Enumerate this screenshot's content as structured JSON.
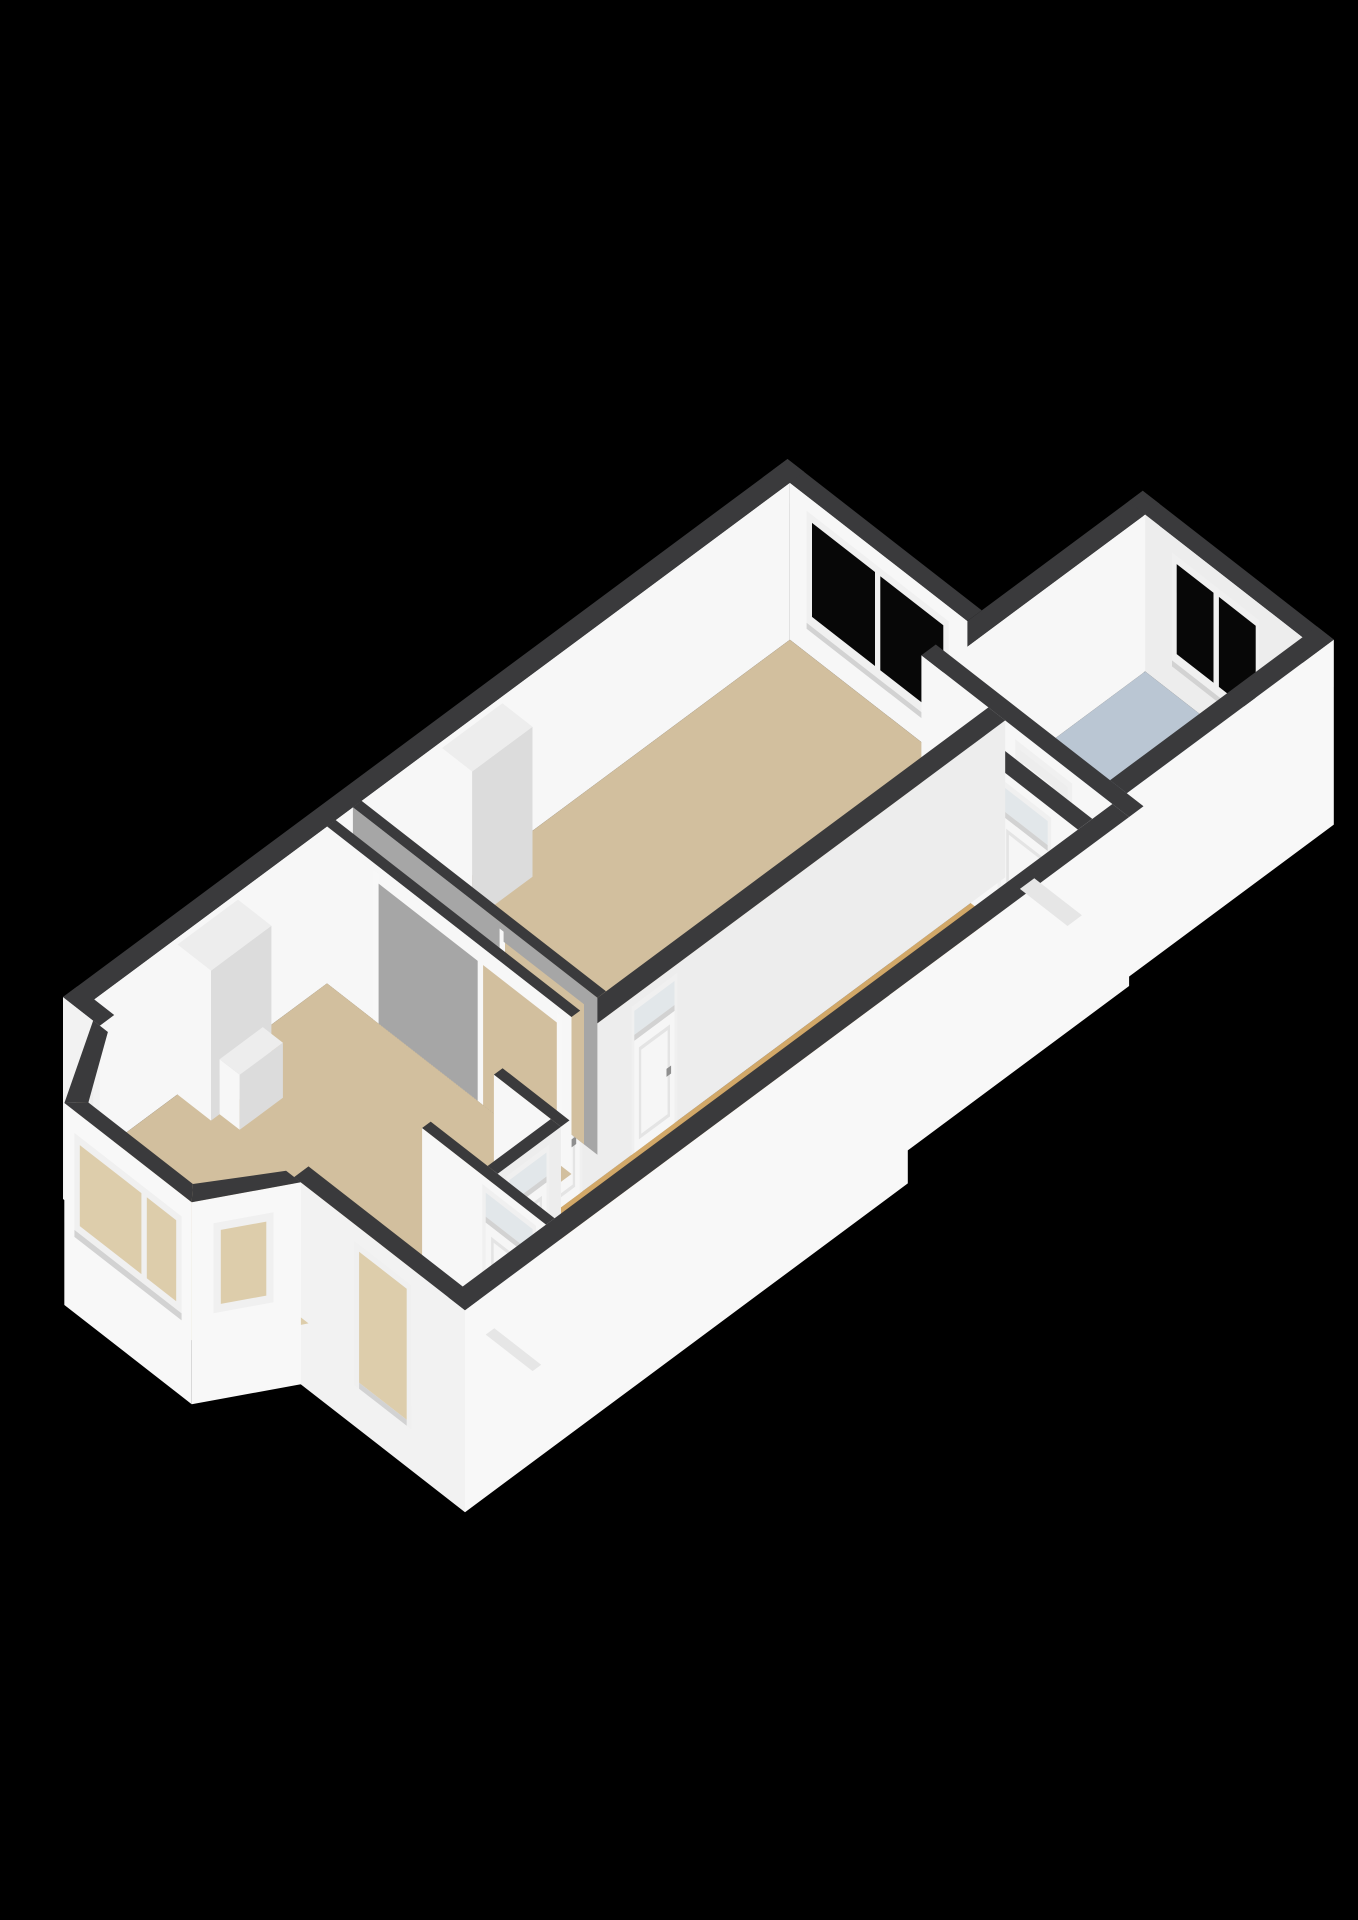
{
  "scene": {
    "type": "3d-floor-plan-render",
    "view": "isometric-birdseye",
    "background": "#000000",
    "floor_label": "ground-floor"
  },
  "colors": {
    "bg": "#000000",
    "wallTop": "#3a3a3c",
    "wallTopSoft": "#434345",
    "extWhite": "#f2f2f2",
    "extBright": "#f8f8f8",
    "intWhite": "#f7f7f7",
    "intLight": "#ededed",
    "intShade": "#dcdcdc",
    "intGray": "#a6a6a6",
    "floorTan": "#d2bf9e",
    "floorTanLight": "#ddcdab",
    "floorAmber": "#d2a868",
    "floorBlue": "#bac6d3",
    "floorGray": "#bdbdbd",
    "glassDark": "#070707",
    "glassLight": "#e2e7ea",
    "frame": "#f0f0f0",
    "frameShade": "#d2d2d2",
    "door": "#f6f6f6",
    "doorPanel": "#e4e4e4",
    "handle": "#8f8f8f",
    "stairWhite": "#f0f1f3",
    "stepShade": "#d8dde2",
    "threshold": "#e6e6e6"
  },
  "rooms": [
    {
      "id": "living-room-front",
      "floor_color": "floorTan"
    },
    {
      "id": "living-room-back",
      "floor_color": "floorTan"
    },
    {
      "id": "bay-window-nook",
      "floor_color": "floorTanLight"
    },
    {
      "id": "hallway",
      "floor_color": "floorAmber"
    },
    {
      "id": "entrance-vestibule",
      "floor_color": "floorAmber"
    },
    {
      "id": "toilet",
      "floor_color": "floorGray"
    },
    {
      "id": "rear-vestibule",
      "floor_color": "floorAmber"
    },
    {
      "id": "stair-hall",
      "floor_color": "floorBlue"
    }
  ],
  "features": {
    "windows": [
      {
        "id": "back-room-window",
        "panes": 2,
        "glass": "glassDark"
      },
      {
        "id": "stair-hall-window",
        "panes": 2,
        "glass": "glassDark"
      },
      {
        "id": "bay-front-window",
        "panes": 2,
        "glass": "floorTanLight"
      },
      {
        "id": "bay-left-window",
        "panes": 1,
        "glass": "floorTanLight"
      },
      {
        "id": "bay-right-window",
        "panes": 1,
        "glass": "floorTanLight"
      }
    ],
    "doors": [
      {
        "id": "front-door-opening",
        "type": "exterior"
      },
      {
        "id": "vestibule-door",
        "type": "interior-transom"
      },
      {
        "id": "toilet-door",
        "type": "interior-transom"
      },
      {
        "id": "hall-to-front-room-door",
        "type": "interior-transom"
      },
      {
        "id": "hall-to-back-room-door",
        "type": "interior-transom"
      },
      {
        "id": "rear-vestibule-door",
        "type": "interior-transom"
      },
      {
        "id": "stair-hall-door",
        "type": "interior"
      }
    ],
    "stairs": {
      "id": "staircase",
      "location": "stair-hall"
    },
    "chimneys": [
      {
        "id": "front-room-chimney-breast"
      },
      {
        "id": "back-room-chimney-breast"
      }
    ]
  }
}
